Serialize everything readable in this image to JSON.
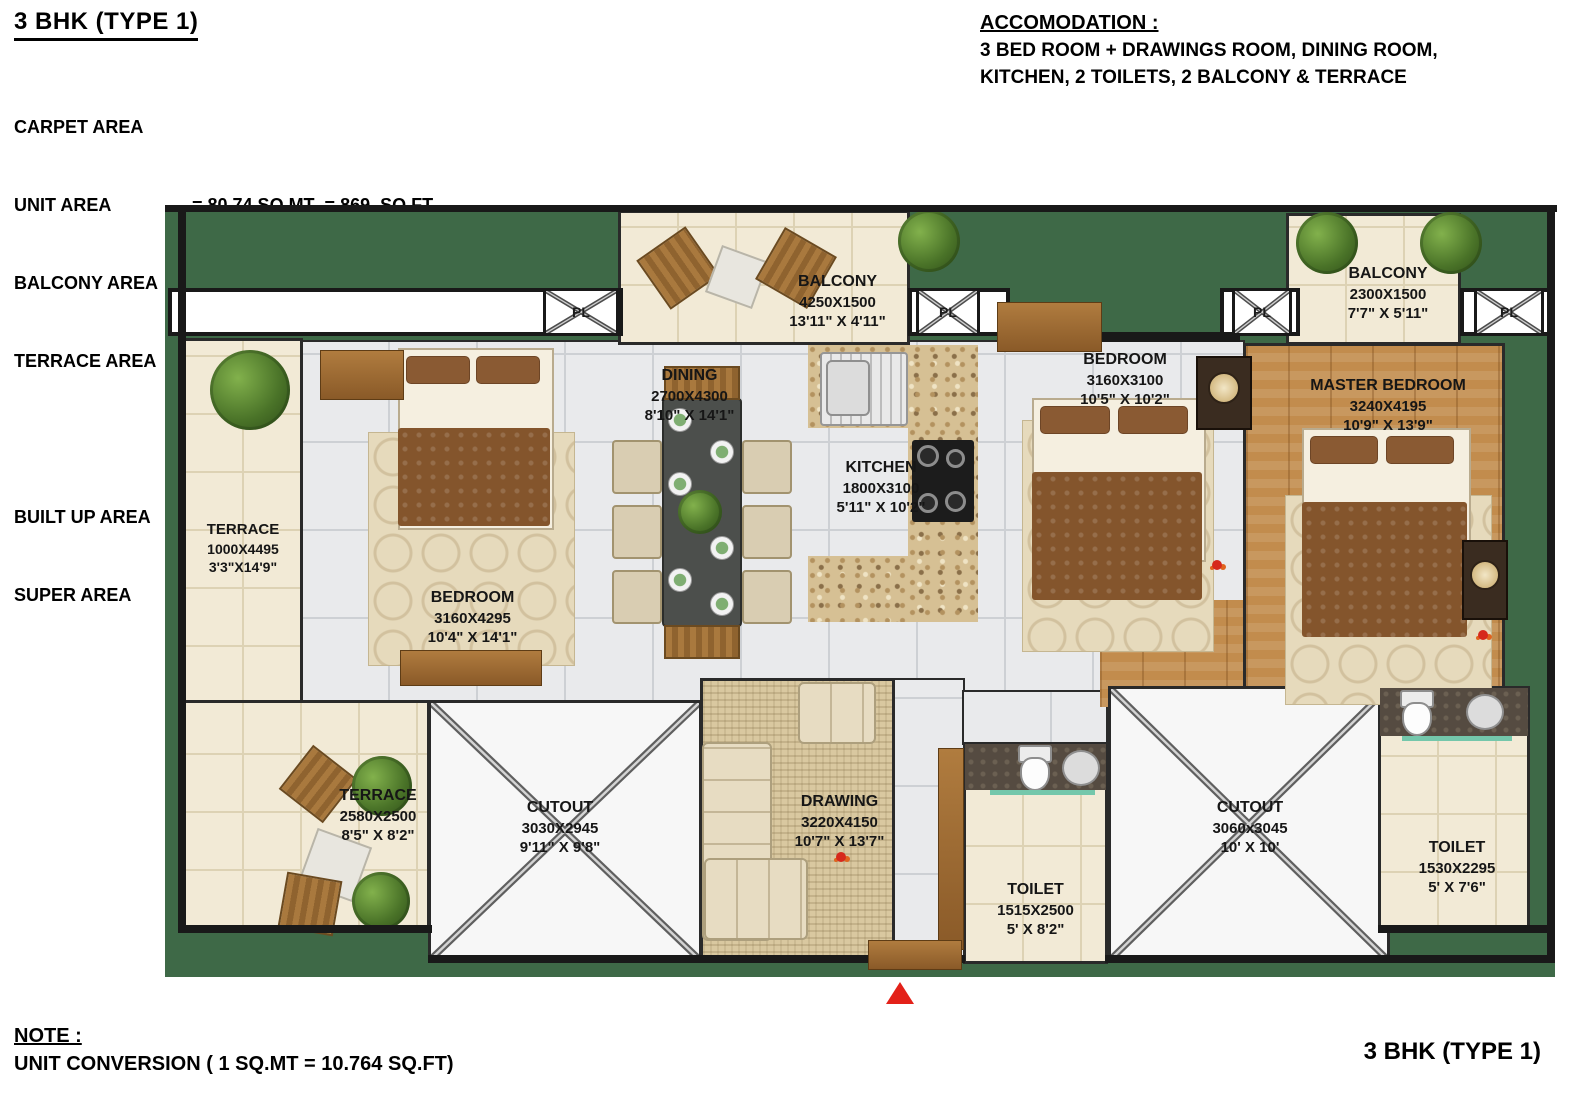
{
  "header": {
    "title": "3 BHK (TYPE 1)"
  },
  "carpet": {
    "heading": "CARPET AREA",
    "rows": [
      {
        "label": "UNIT AREA",
        "value": "= 80.74 SQ.MT  = 869  SQ.FT"
      },
      {
        "label": "BALCONY AREA",
        "value": "= 09.10 SQ.MT  = 98   SQ.FT"
      },
      {
        "label": "TERRACE AREA",
        "value": "= 11.18SQ.MT  = 120 SQ.FT"
      }
    ],
    "rows2": [
      {
        "label": "BUILT UP AREA",
        "value": "= 111.54 SQ.MT = 1201 SQ.FT"
      },
      {
        "label": "SUPER AREA",
        "value": "= 152.14 SQ.MT = 1638 SQ.FT"
      }
    ]
  },
  "accommodation": {
    "heading": "ACCOMODATION :",
    "line1": "3 BED ROOM + DRAWINGS ROOM, DINING ROOM,",
    "line2": "KITCHEN, 2 TOILETS, 2 BALCONY & TERRACE"
  },
  "note": {
    "heading": "NOTE :",
    "line": "UNIT CONVERSION ( 1 SQ.MT = 10.764 SQ.FT)"
  },
  "footer": {
    "title": "3 BHK (TYPE 1)"
  },
  "marker": {
    "pl": "PL"
  },
  "rooms": {
    "balcony_top": {
      "name": "BALCONY",
      "mm": "4250X1500",
      "ft": "13'11\" X 4'11\""
    },
    "balcony_right": {
      "name": "BALCONY",
      "mm": "2300X1500",
      "ft": "7'7\" X 5'11\""
    },
    "terrace_left": {
      "name": "TERRACE",
      "mm": "1000X4495",
      "ft": "3'3\"X14'9\""
    },
    "terrace_bottom": {
      "name": "TERRACE",
      "mm": "2580X2500",
      "ft": "8'5\" X 8'2\""
    },
    "bedroom_left": {
      "name": "BEDROOM",
      "mm": "3160X4295",
      "ft": "10'4\" X 14'1\""
    },
    "dining": {
      "name": "DINING",
      "mm": "2700X4300",
      "ft": "8'10\" X 14'1\""
    },
    "kitchen": {
      "name": "KITCHEN",
      "mm": "1800X3100",
      "ft": "5'11\" X 10'2\""
    },
    "bedroom_mid": {
      "name": "BEDROOM",
      "mm": "3160X3100",
      "ft": "10'5\" X 10'2\""
    },
    "master_bedroom": {
      "name": "MASTER BEDROOM",
      "mm": "3240X4195",
      "ft": "10'9\" X 13'9\""
    },
    "drawing": {
      "name": "DRAWING",
      "mm": "3220X4150",
      "ft": "10'7\" X 13'7\""
    },
    "cutout_left": {
      "name": "CUTOUT",
      "mm": "3030X2945",
      "ft": "9'11\" X 9'8\""
    },
    "cutout_right": {
      "name": "CUTOUT",
      "mm": "3060x3045",
      "ft": "10' X 10'"
    },
    "toilet_center": {
      "name": "TOILET",
      "mm": "1515X2500",
      "ft": "5' X 8'2\""
    },
    "toilet_right": {
      "name": "TOILET",
      "mm": "1530X2295",
      "ft": "5' X 7'6\""
    }
  },
  "colors": {
    "void_green": "#3e6947",
    "wood": "#c28c4d",
    "cream": "#f2ead6",
    "entry_red": "#e32119"
  }
}
